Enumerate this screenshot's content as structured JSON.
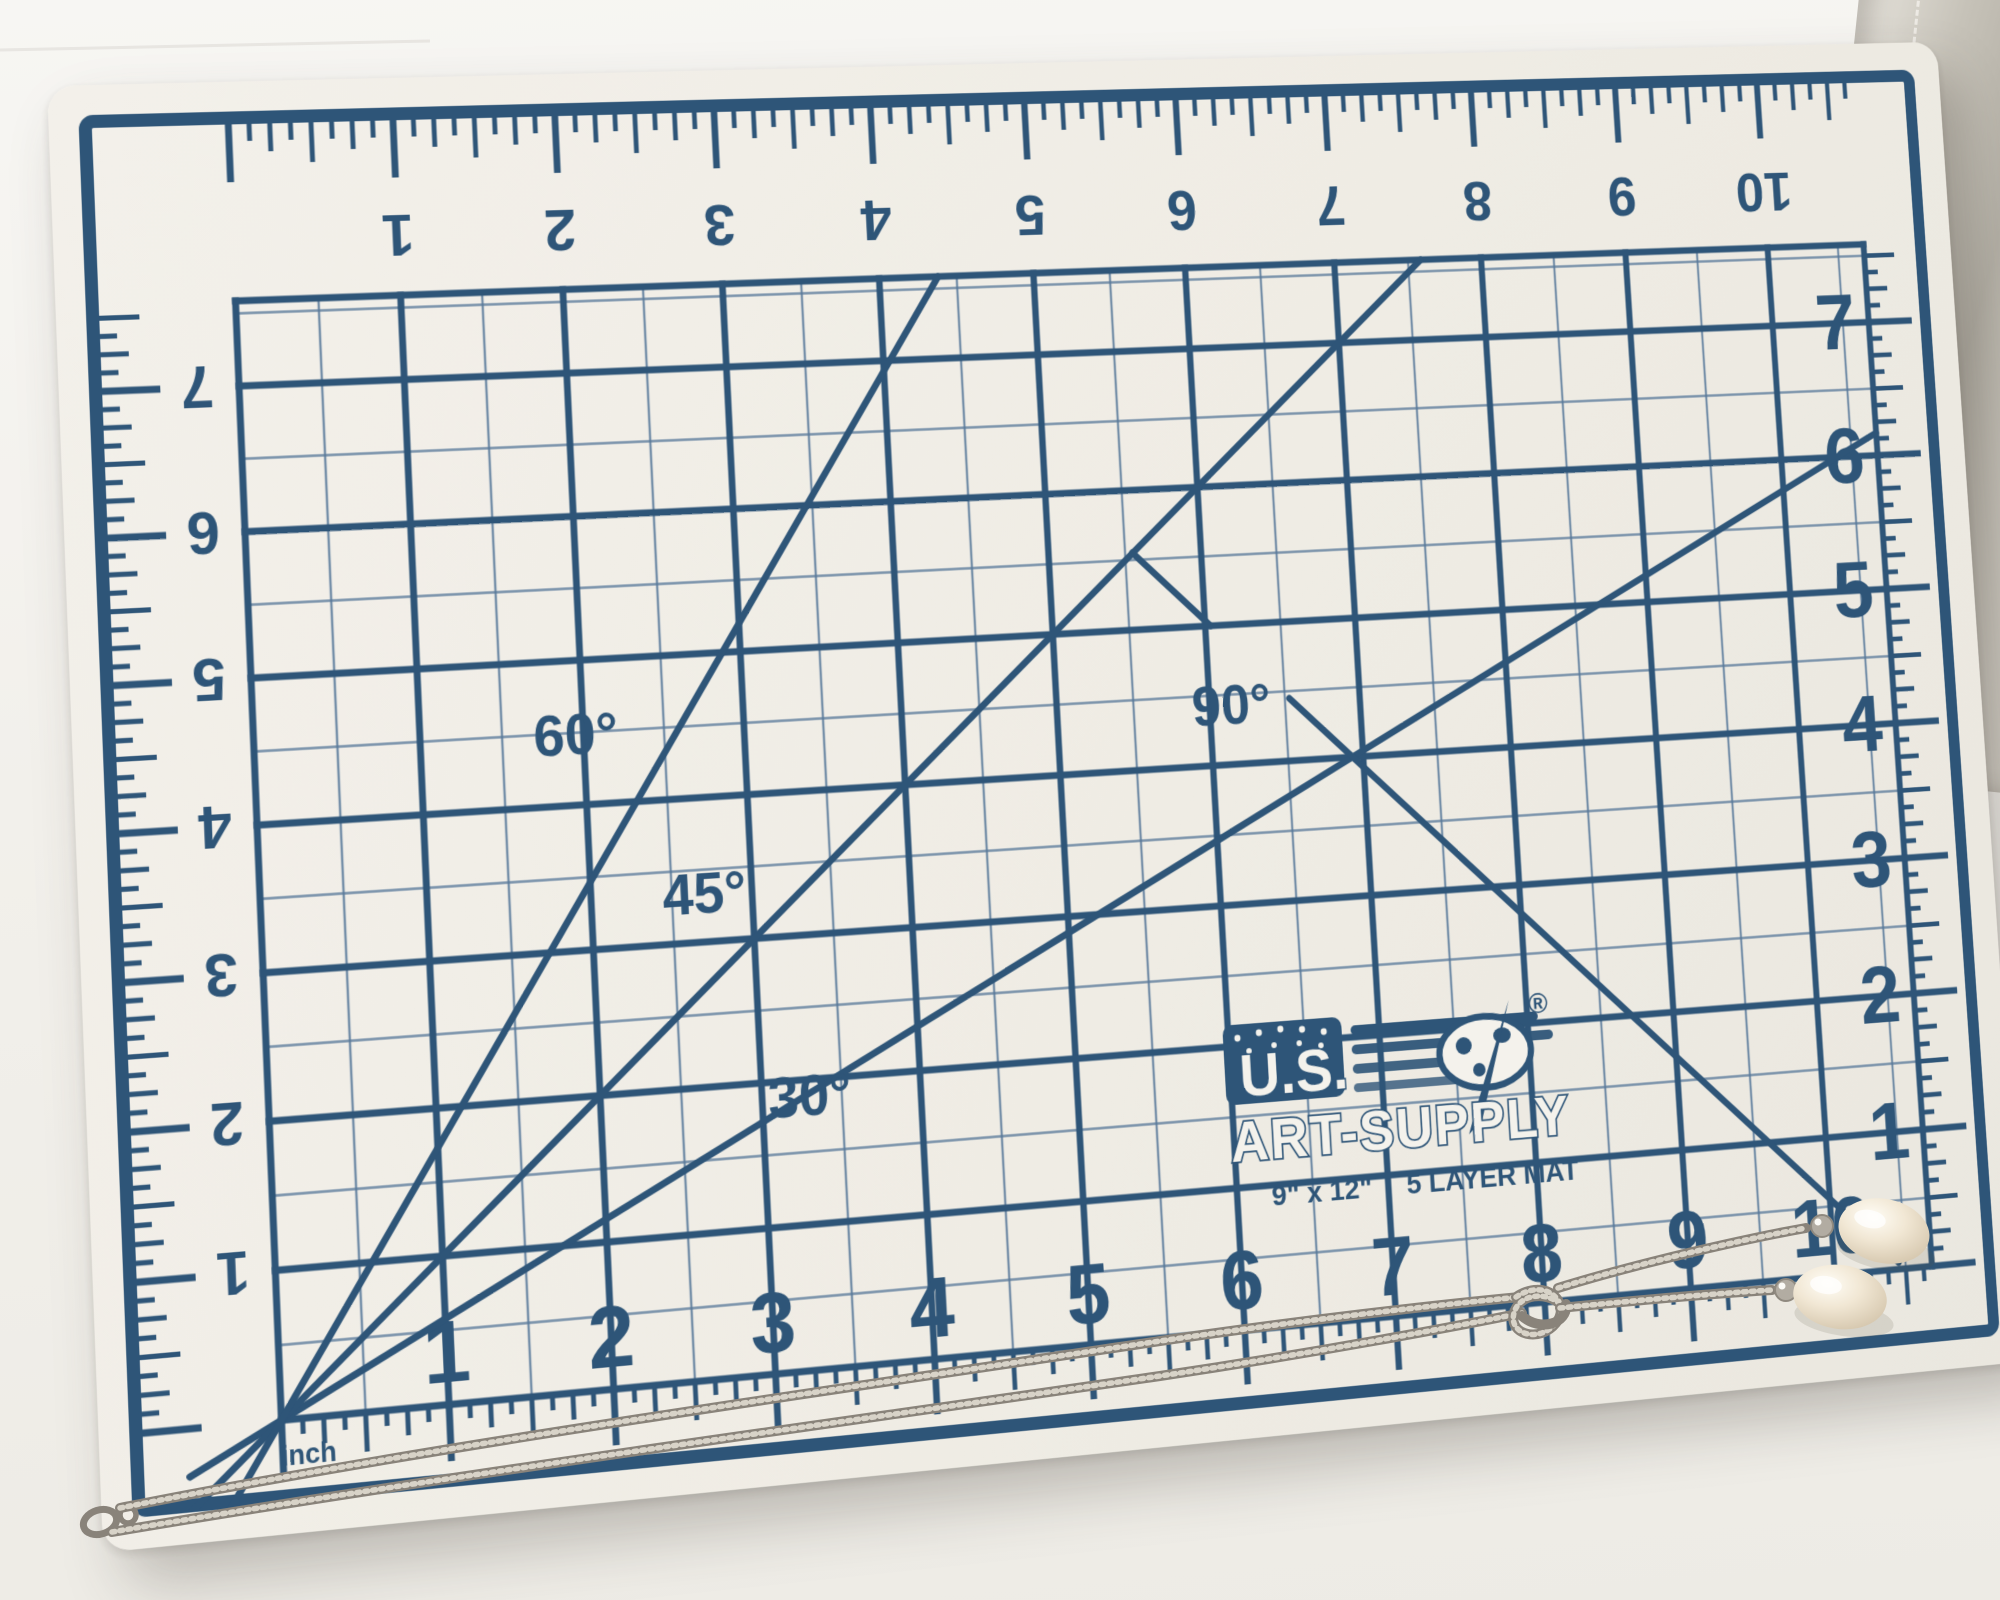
{
  "mat": {
    "brand": {
      "line1": "U.S.",
      "line2": "ART-SUPPLY",
      "registered": "®"
    },
    "size_label": "9\" x 12\"",
    "layers_label": "5 LAYER MAT",
    "unit_label": "inch",
    "rulers": {
      "top_numbers": [
        "1",
        "2",
        "3",
        "4",
        "5",
        "6",
        "7",
        "8",
        "9",
        "10"
      ],
      "bottom_numbers": [
        "1",
        "2",
        "3",
        "4",
        "5",
        "6",
        "7",
        "8",
        "9",
        "10"
      ],
      "left_numbers": [
        "7",
        "6",
        "5",
        "4",
        "3",
        "2",
        "1"
      ],
      "right_numbers": [
        "7",
        "6",
        "5",
        "4",
        "3",
        "2",
        "1"
      ]
    },
    "angle_guides": [
      {
        "label": "30°",
        "degrees": 30
      },
      {
        "label": "45°",
        "degrees": 45
      },
      {
        "label": "60°",
        "degrees": 60
      },
      {
        "label": "90°",
        "degrees": 90
      }
    ],
    "colors": {
      "print": "#2e5578",
      "minor_line": "#58799a",
      "surface": "#f0ede5"
    }
  },
  "necklace": {
    "pearl_count": 2,
    "colors": {
      "chain": "#89837a",
      "chain_highlight": "#d8d3c8",
      "pearl": "#f1e7d4",
      "pearl_shadow": "#d2c3a9",
      "bead": "#b2aca2"
    }
  },
  "background": {
    "surface": "#f3f1ed",
    "leather_edge": "#b9b5ab",
    "leather_stitch": "#efece6"
  }
}
